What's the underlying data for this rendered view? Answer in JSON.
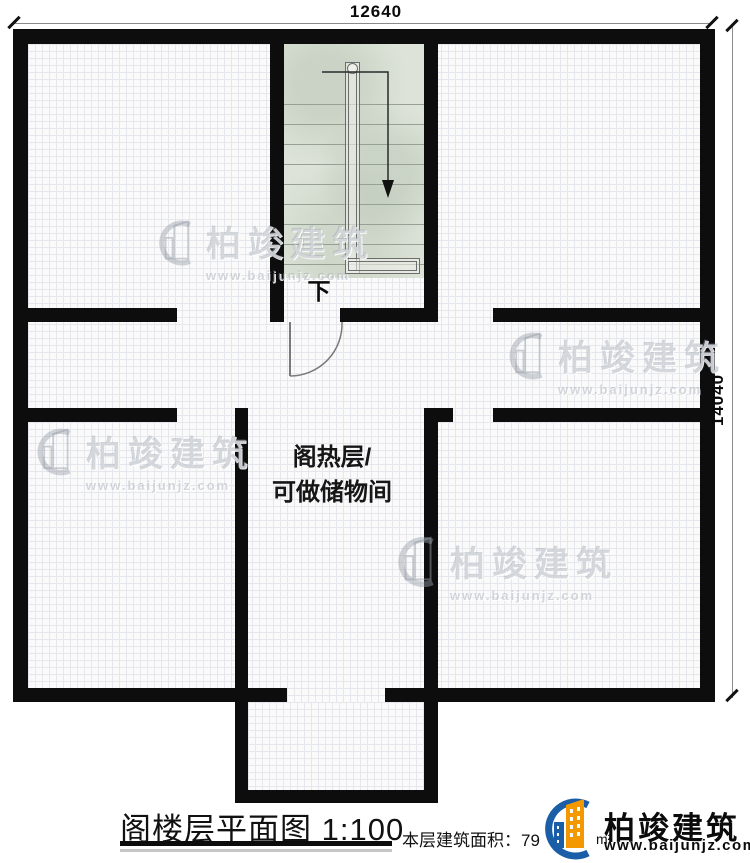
{
  "dimensions": {
    "width_label": "12640",
    "height_label": "14040"
  },
  "stairs": {
    "down_label": "下"
  },
  "rooms": {
    "attic_line1": "阁热层/",
    "attic_line2": "可做储物间"
  },
  "footer": {
    "title": "阁楼层平面图",
    "scale": "1:100",
    "area_label": "本层建筑面积：",
    "area_value": "79",
    "area_unit": "m²"
  },
  "brand": {
    "name": "柏竣建筑",
    "website": "www.baijunjz.com"
  },
  "colors": {
    "wall": "#0d0d0d",
    "stair_fill": "#dde3d8",
    "logo_blue": "#1b5ea8",
    "logo_orange": "#f39800",
    "wm_gray": "#9aa1ab"
  }
}
